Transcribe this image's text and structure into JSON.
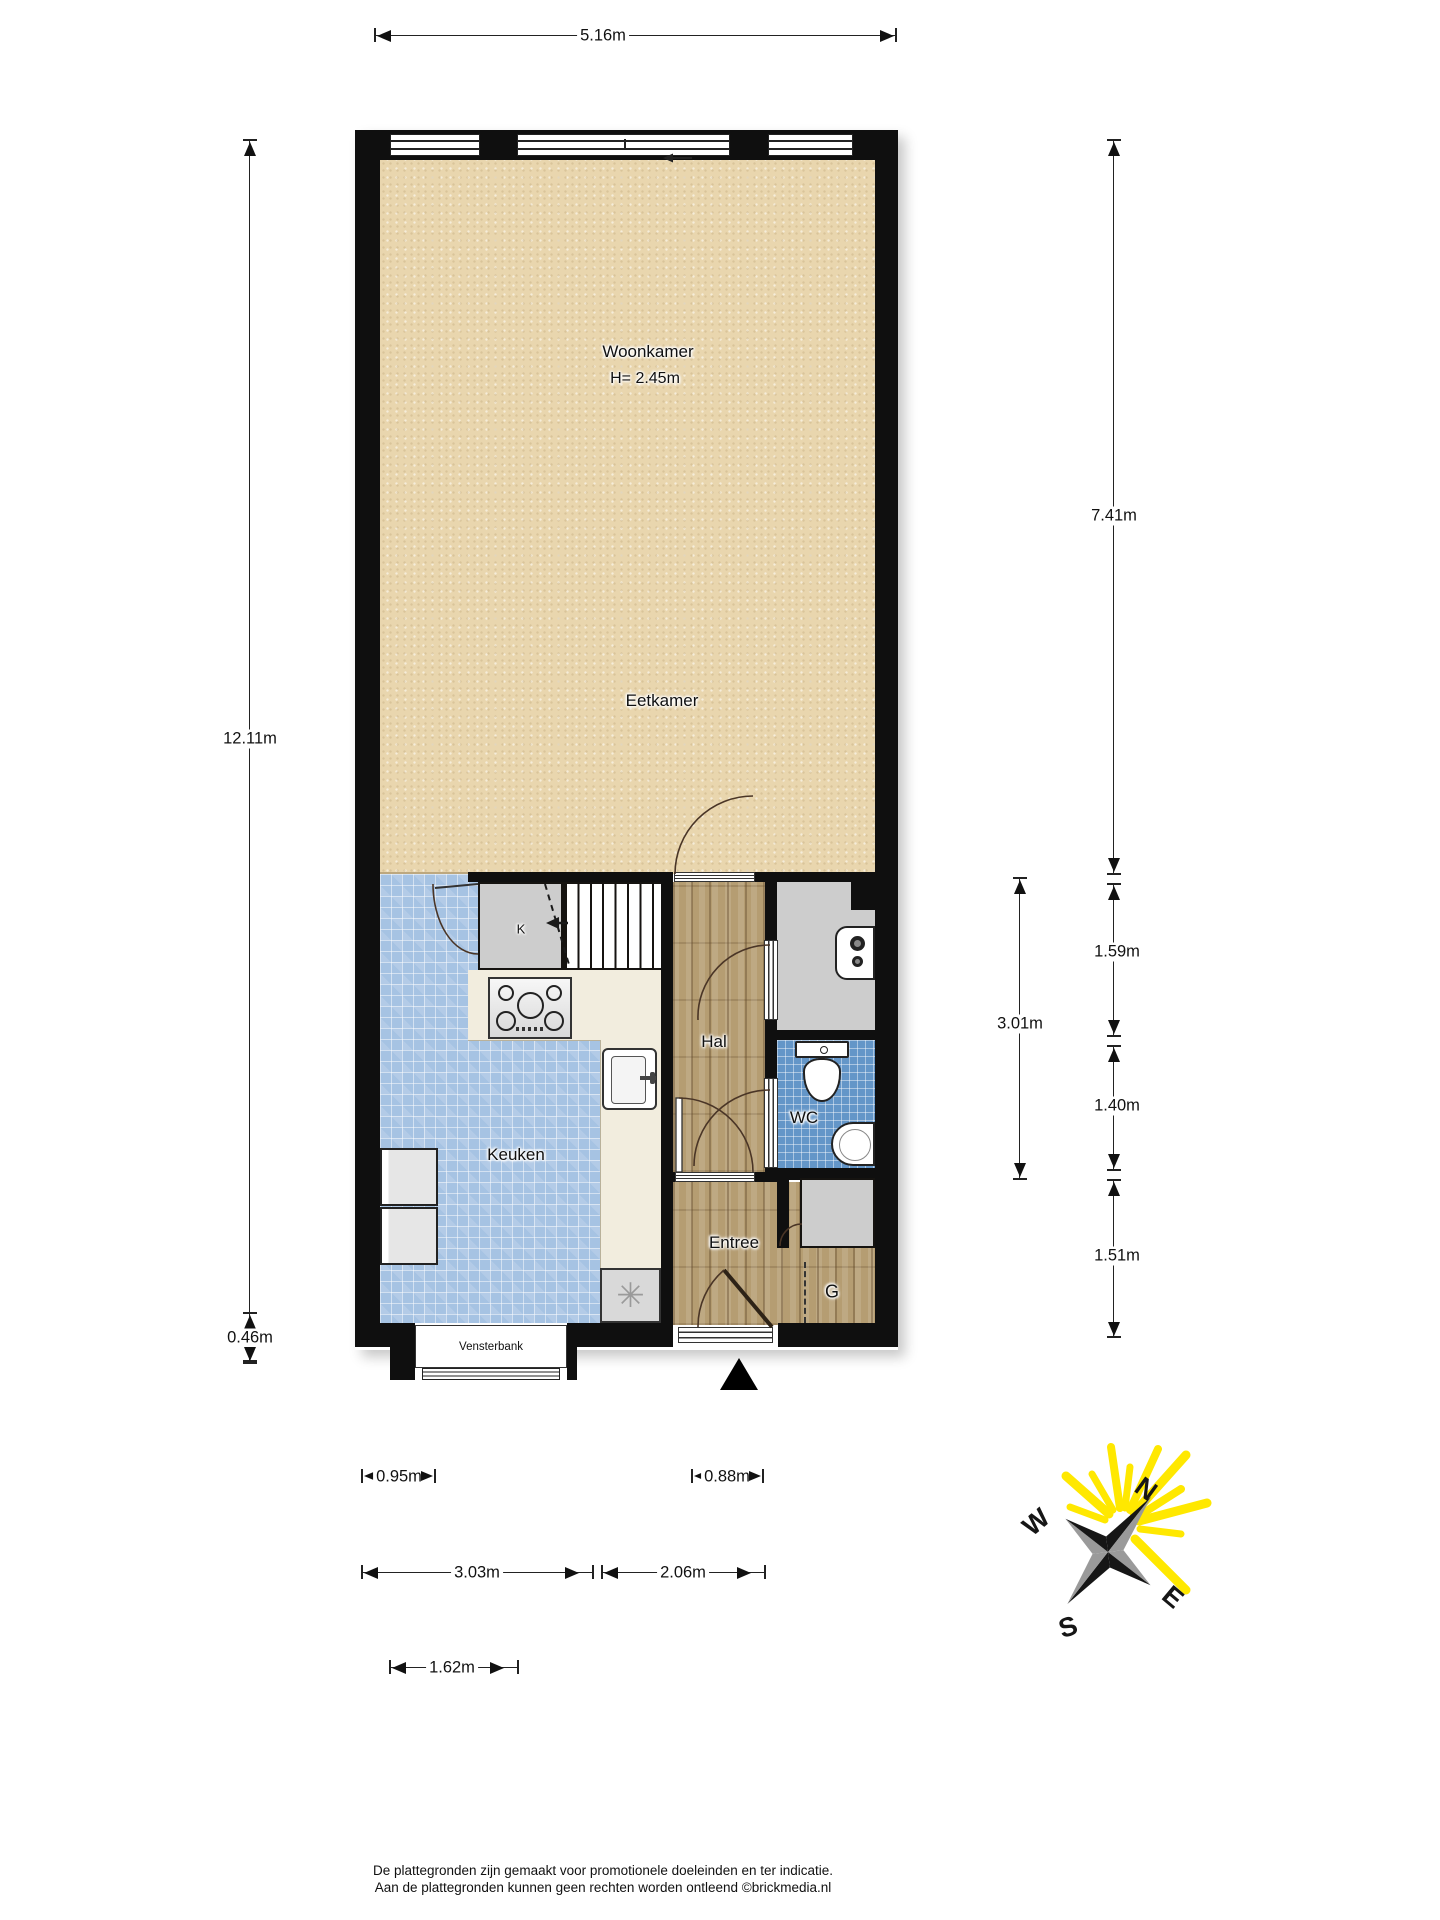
{
  "floorplan": {
    "rooms": {
      "woonkamer": {
        "label": "Woonkamer",
        "height_note": "H= 2.45m"
      },
      "eetkamer": {
        "label": "Eetkamer"
      },
      "keuken": {
        "label": "Keuken"
      },
      "hal": {
        "label": "Hal"
      },
      "wc": {
        "label": "WC"
      },
      "entree": {
        "label": "Entree"
      },
      "garderobe": {
        "label": "G"
      },
      "kast": {
        "label": "K"
      },
      "vensterbank": {
        "label": "Vensterbank"
      }
    },
    "fixtures": {
      "washer_symbol": "✳"
    },
    "colors": {
      "floor_living": "#e9d6ae",
      "floor_kitchen_tiles": "#a6c3e3",
      "floor_wc_tiles": "#6496c8",
      "floor_wood": "#b59d72",
      "walls": "#0f0f0f",
      "compass_rays": "#ffec00"
    }
  },
  "dimensions": {
    "top_width": "5.16m",
    "left_height": "12.11m",
    "left_offset": "0.46m",
    "right_upper": "7.41m",
    "right_hal": "1.59m",
    "right_group": "3.01m",
    "right_wc": "1.40m",
    "right_entree": "1.51m",
    "bottom_fridge": "0.95m",
    "bottom_door": "0.88m",
    "bottom_kitchen": "3.03m",
    "bottom_entree": "2.06m",
    "bottom_window": "1.62m"
  },
  "compass": {
    "north": "N",
    "east": "E",
    "south": "S",
    "west": "W"
  },
  "footer": {
    "line1": "De plattegronden zijn gemaakt voor promotionele doeleinden en ter indicatie.",
    "line2": "Aan de plattegronden kunnen geen rechten worden ontleend ©brickmedia.nl"
  }
}
